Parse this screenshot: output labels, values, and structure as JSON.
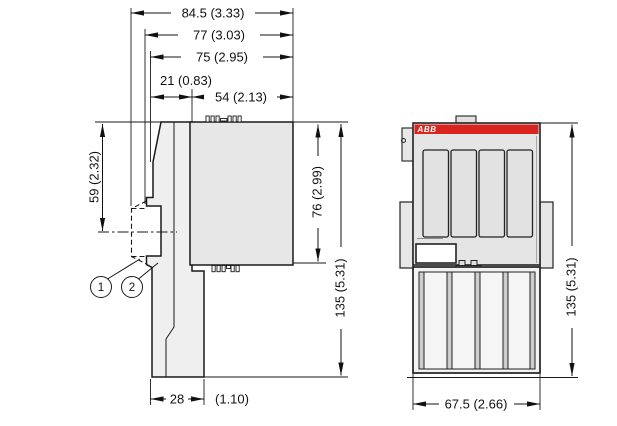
{
  "drawing": {
    "kind": "technical-dimension-drawing",
    "subject": "ABB I/O module — side and front dimension views",
    "units": "mm (inch)"
  },
  "dims": {
    "total_depth": "84.5 (3.33)",
    "depth_with_rail": "77 (3.03)",
    "module_depth": "75 (2.95)",
    "rear_depth": "21 (0.83)",
    "terminal_depth": "54 (2.13)",
    "rail_offset": "59 (2.32)",
    "terminal_height": "76 (2.99)",
    "height_side": "135 (5.31)",
    "base_width": "28",
    "base_width_inch": "(1.10)",
    "front_width": "67.5 (2.66)",
    "height_front": "135 (5.31)"
  },
  "callouts": {
    "one": "1",
    "two": "2"
  },
  "logo": {
    "text": "ABB"
  },
  "colors": {
    "accent_red": "#da241f",
    "line": "#1a1a1a",
    "body_fill": "#ececec",
    "block_fill": "#e7e7e7",
    "terminal_fill": "#f2f2f2",
    "strip_fill": "#cdcdcd"
  }
}
